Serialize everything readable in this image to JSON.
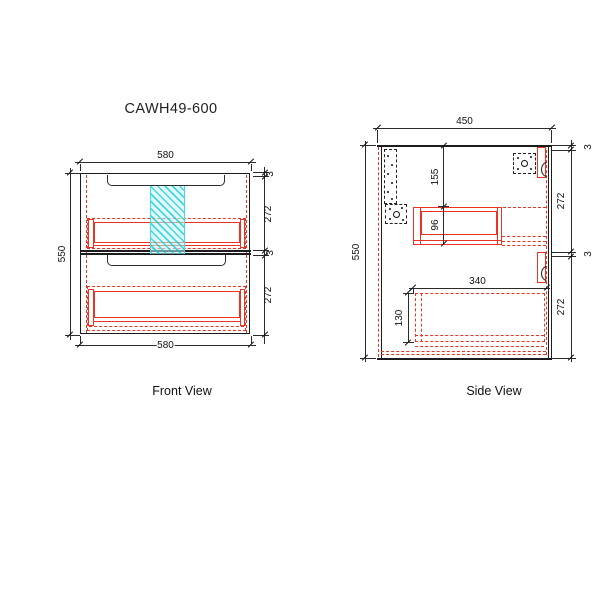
{
  "title": "CAWH49-600",
  "front": {
    "label": "Front View",
    "width_top": "580",
    "width_bottom": "580",
    "height": "550",
    "gap_top": "3",
    "top_section": "272",
    "gap_mid": "3",
    "bottom_section": "272"
  },
  "side": {
    "label": "Side View",
    "depth": "450",
    "height": "550",
    "gap_top": "3",
    "top_section": "272",
    "gap_mid": "3",
    "bottom_section": "272",
    "top_clearance": "155",
    "drawer1_box_height": "96",
    "drawer2_box_length": "340",
    "drawer2_box_height": "130"
  },
  "colors": {
    "line": "#1c1c1c",
    "red": "#ea3323",
    "cyan": "#3cdde8"
  }
}
